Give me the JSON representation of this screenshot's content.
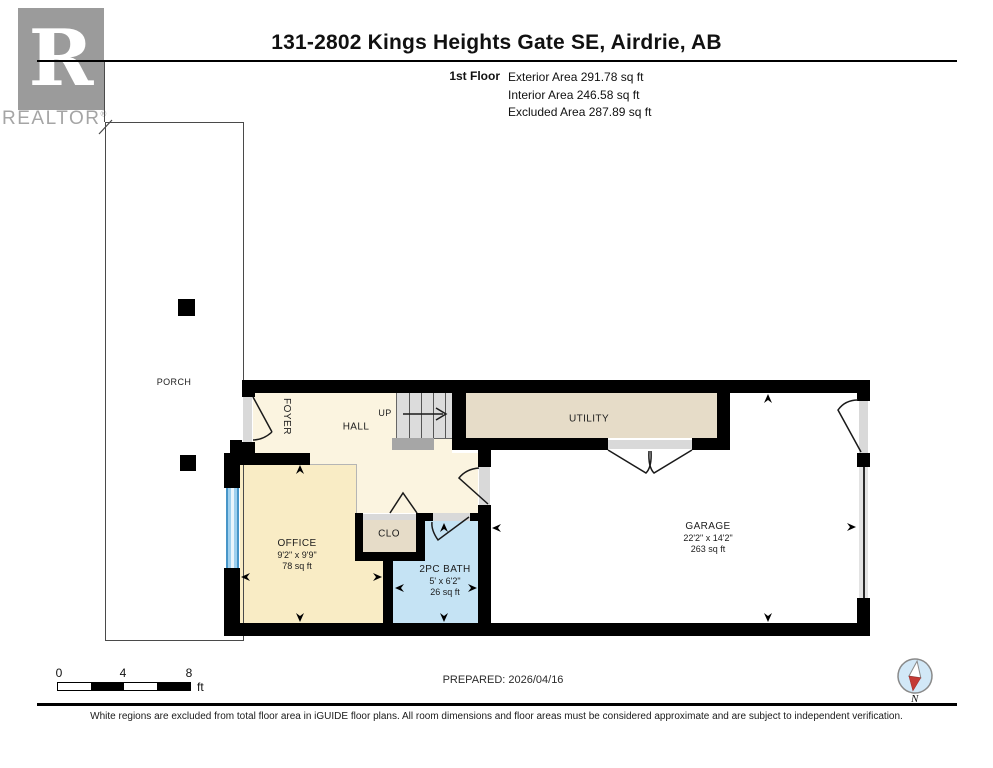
{
  "header": {
    "logo": {
      "letter": "R",
      "brand": "REALTOR",
      "reg": "®"
    },
    "title": "131-2802 Kings Heights Gate SE, Airdrie, AB",
    "floor_label": "1st Floor",
    "area_lines": [
      "Exterior Area 291.78 sq ft",
      "Interior Area 246.58 sq ft",
      "Excluded Area 287.89 sq ft"
    ]
  },
  "rooms": {
    "porch": {
      "label": "PORCH"
    },
    "foyer": {
      "label": "FOYER"
    },
    "hall": {
      "label": "HALL"
    },
    "stairs": {
      "label": "UP"
    },
    "utility": {
      "label": "UTILITY"
    },
    "office": {
      "label": "OFFICE",
      "dims": "9'2\" x 9'9\"",
      "area": "78 sq ft"
    },
    "closet": {
      "label": "CLO"
    },
    "bath": {
      "label": "2PC BATH",
      "dims": "5' x 6'2\"",
      "area": "26 sq ft"
    },
    "garage": {
      "label": "GARAGE",
      "dims": "22'2\" x 14'2\"",
      "area": "263 sq ft"
    }
  },
  "footer": {
    "scale": {
      "ticks": [
        "0",
        "4",
        "8"
      ],
      "unit": "ft"
    },
    "prepared": "PREPARED: 2026/04/16",
    "compass": {
      "label": "N"
    },
    "disclaimer": "White regions are excluded from total floor area in iGUIDE floor plans. All room dimensions and floor areas must be considered approximate and are subject to independent verification."
  },
  "colors": {
    "wall": "#000000",
    "cream": "#FBF4E0",
    "officeYellow": "#F9ECC5",
    "tan": "#E6DCC8",
    "bathBlue": "#C5E3F4",
    "doorGray": "#D9D9D9",
    "stairGray": "#DCDCDC",
    "landingGray": "#A6A6A6",
    "garageTrack": "#E3E3E3",
    "windowBlue": "#7FC4E8",
    "compassFill": "#D2E8F7",
    "needleRed": "#C43A35",
    "logoGray": "#9B9B9B"
  }
}
